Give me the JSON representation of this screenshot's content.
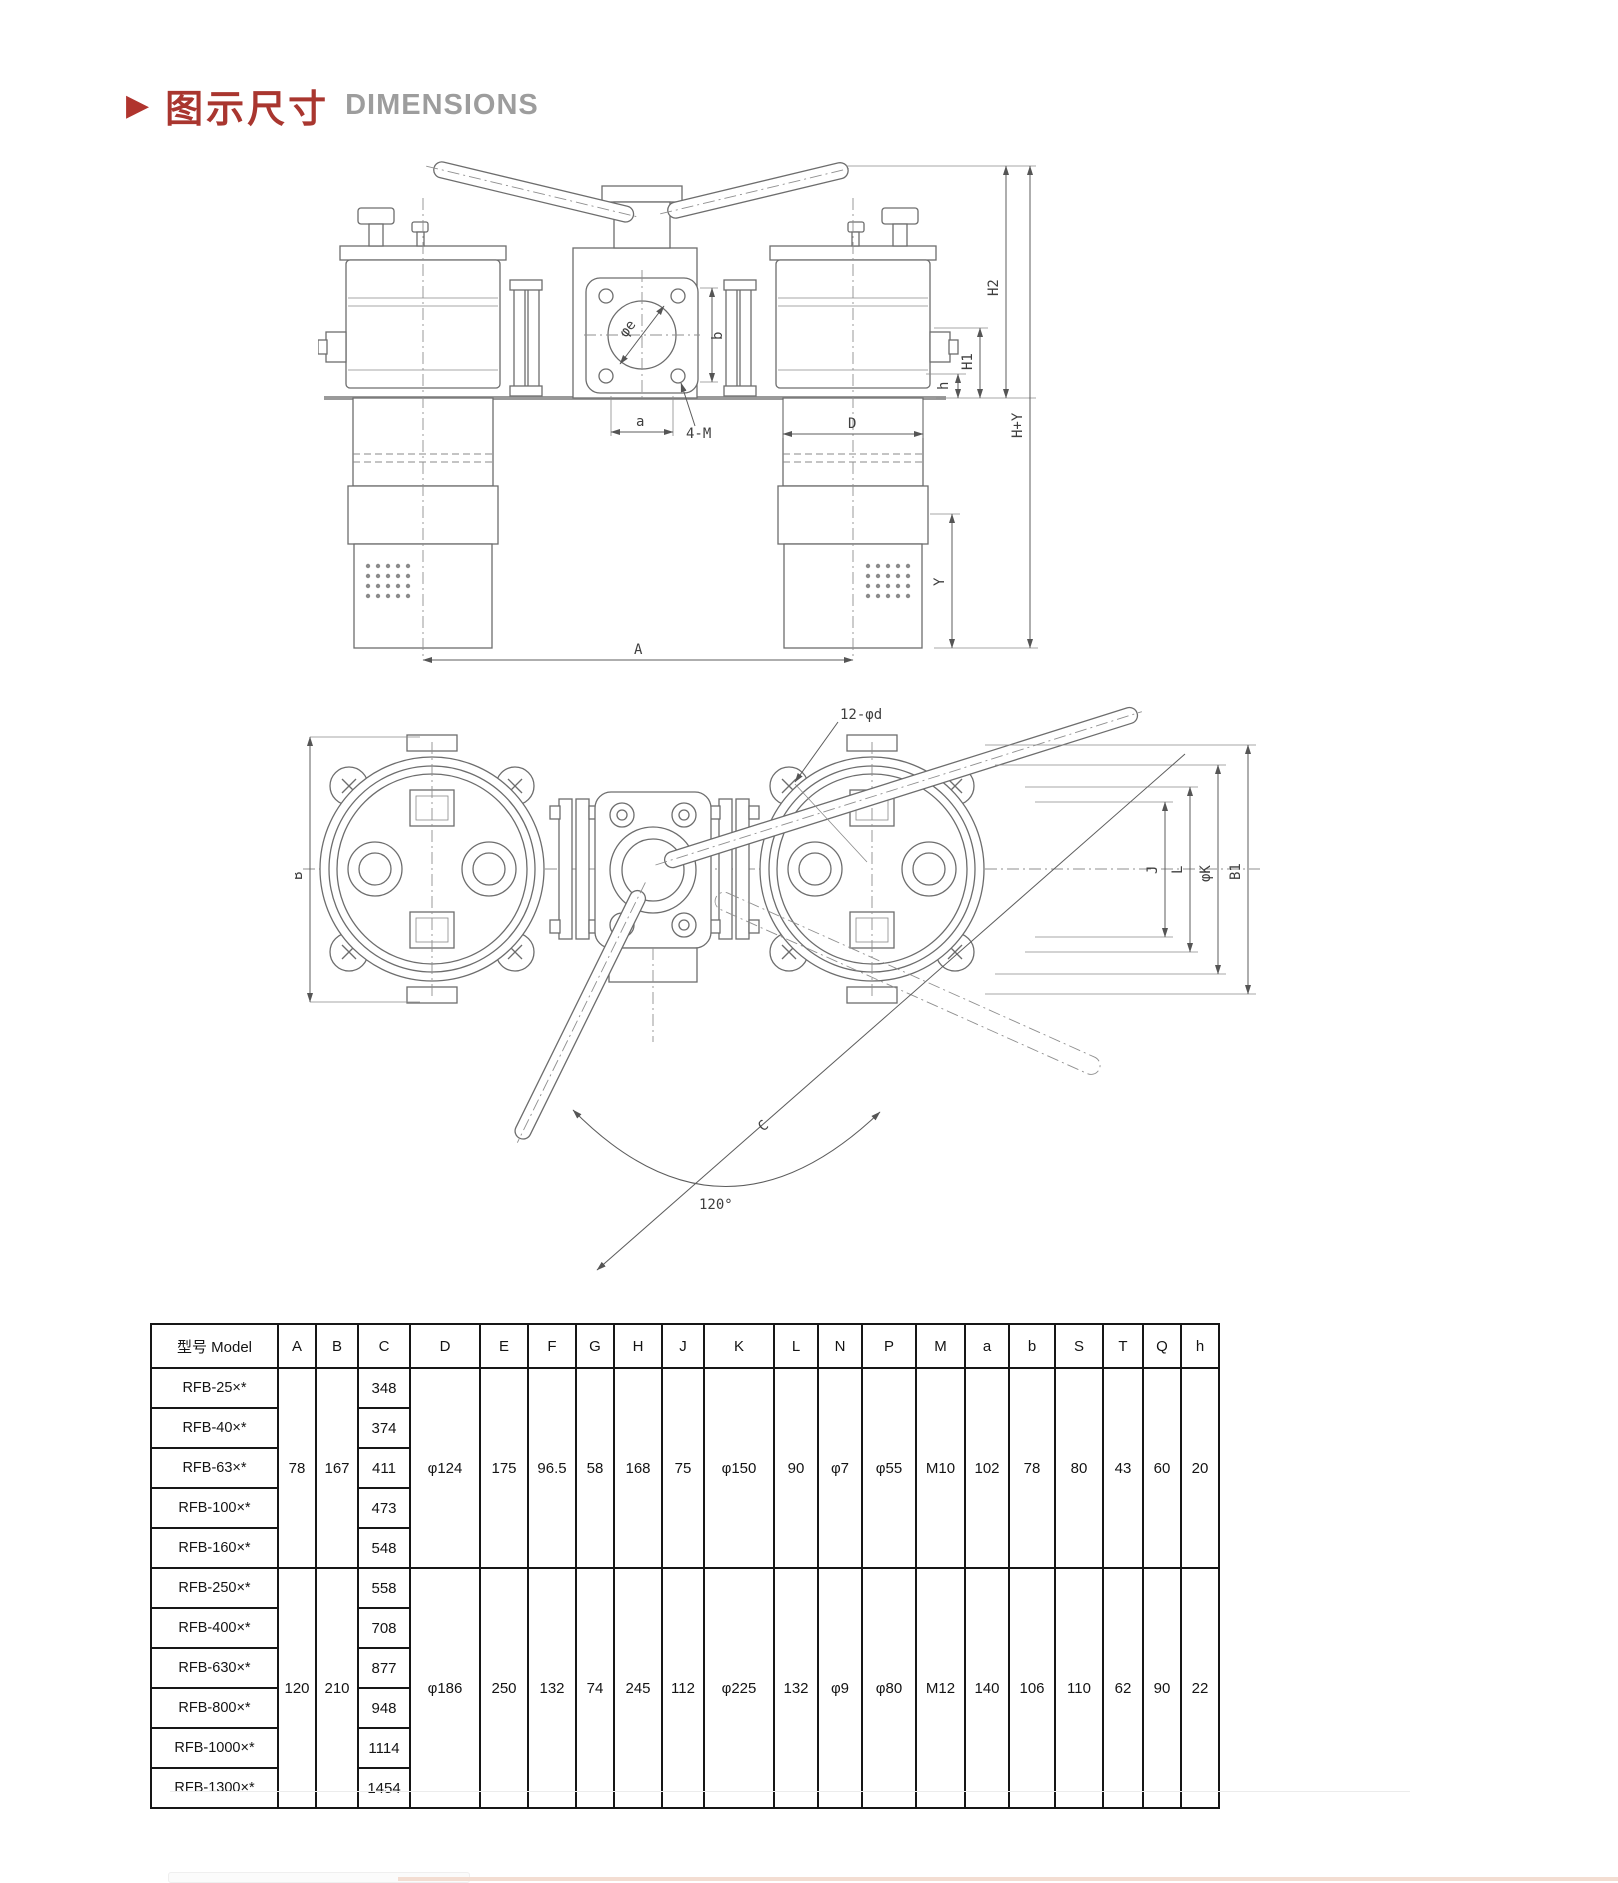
{
  "page": {
    "section_marker": "▶",
    "title_zh": "图示尺寸",
    "title_en": "DIMENSIONS"
  },
  "front_view": {
    "labels": {
      "h2": "H2",
      "h1": "H1",
      "h_small": "h",
      "h_plus_y": "H+Y",
      "y": "Y",
      "d": "D",
      "a_total": "A",
      "a_small": "a",
      "b_small": "b",
      "bolt_spec": "4-M",
      "bore": "φe"
    }
  },
  "top_view": {
    "labels": {
      "hole_spec": "12-φd",
      "b": "B",
      "j": "J",
      "l": "L",
      "k": "φK",
      "b1": "B1",
      "c": "C",
      "angle": "120°"
    }
  },
  "table": {
    "model_header": "型号 Model",
    "columns": [
      "A",
      "B",
      "C",
      "D",
      "E",
      "F",
      "G",
      "H",
      "J",
      "K",
      "L",
      "N",
      "P",
      "M",
      "a",
      "b",
      "S",
      "T",
      "Q",
      "h"
    ],
    "groups": [
      {
        "A": "78",
        "B": "167",
        "D": "φ124",
        "E": "175",
        "F": "96.5",
        "G": "58",
        "H": "168",
        "J": "75",
        "K": "φ150",
        "L": "90",
        "N": "φ7",
        "P": "φ55",
        "M": "M10",
        "a": "102",
        "b": "78",
        "S": "80",
        "T": "43",
        "Q": "60",
        "h": "20"
      },
      {
        "A": "120",
        "B": "210",
        "D": "φ186",
        "E": "250",
        "F": "132",
        "G": "74",
        "H": "245",
        "J": "112",
        "K": "φ225",
        "L": "132",
        "N": "φ9",
        "P": "φ80",
        "M": "M12",
        "a": "140",
        "b": "106",
        "S": "110",
        "T": "62",
        "Q": "90",
        "h": "22"
      }
    ],
    "rows": [
      {
        "model": "RFB-25×*",
        "C": "348"
      },
      {
        "model": "RFB-40×*",
        "C": "374"
      },
      {
        "model": "RFB-63×*",
        "C": "411"
      },
      {
        "model": "RFB-100×*",
        "C": "473"
      },
      {
        "model": "RFB-160×*",
        "C": "548"
      },
      {
        "model": "RFB-250×*",
        "C": "558"
      },
      {
        "model": "RFB-400×*",
        "C": "708"
      },
      {
        "model": "RFB-630×*",
        "C": "877"
      },
      {
        "model": "RFB-800×*",
        "C": "948"
      },
      {
        "model": "RFB-1000×*",
        "C": "1114"
      },
      {
        "model": "RFB-1300×*",
        "C": "1454"
      }
    ]
  }
}
